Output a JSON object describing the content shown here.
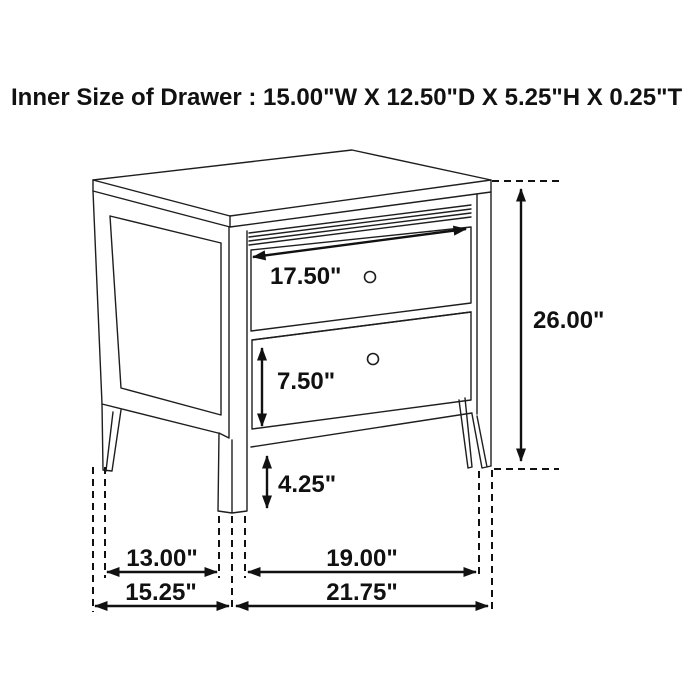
{
  "title": "Inner Size of Drawer : 15.00\"W X 12.50\"D X 5.25\"H X 0.25\"T",
  "colors": {
    "background": "#ffffff",
    "line": "#1e1e1e",
    "text": "#111111"
  },
  "dimensions": {
    "drawer_width": "17.50\"",
    "lower_drawer_height": "7.50\"",
    "bottom_clearance": "4.25\"",
    "overall_height": "26.00\"",
    "depth_between_legs": "13.00\"",
    "width_between_legs": "19.00\"",
    "overall_depth": "15.25\"",
    "overall_width": "21.75\""
  }
}
